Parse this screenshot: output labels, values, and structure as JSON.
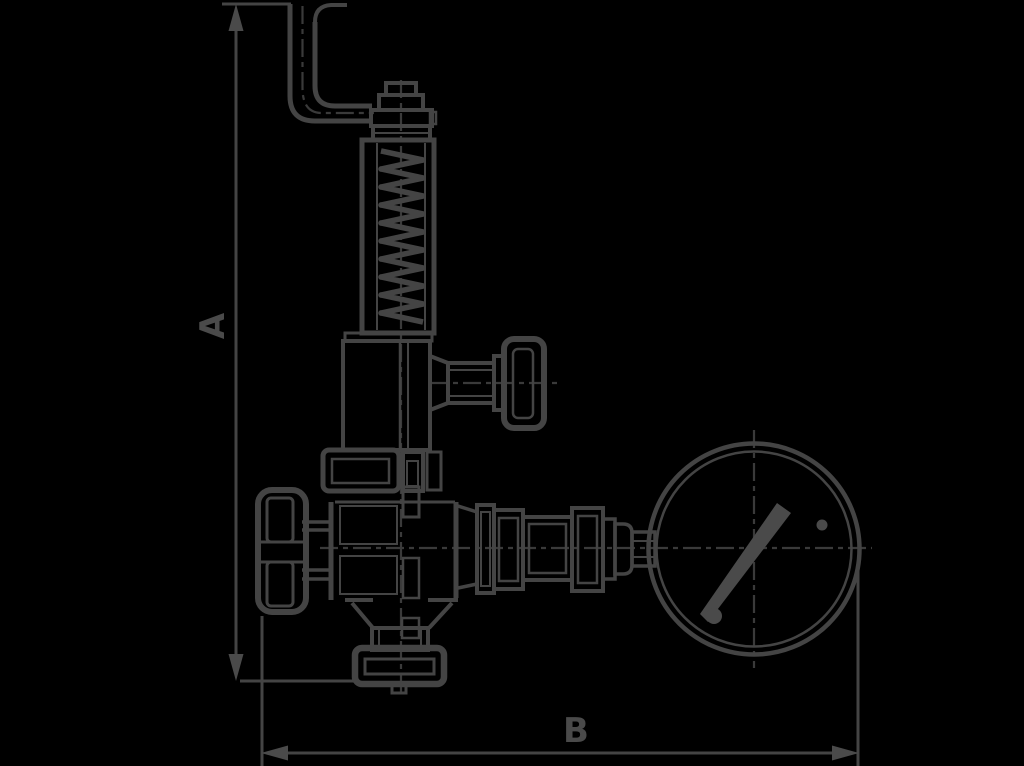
{
  "diagram": {
    "type": "technical-drawing",
    "dimension_labels": {
      "height": "A",
      "width": "B"
    },
    "colors": {
      "background": "#000000",
      "line": "#444444",
      "accent_fill": "#4a4a4a"
    },
    "components": [
      "discharge-elbow-pipe",
      "adjusting-cap",
      "spring-housing",
      "spring-coil",
      "bonnet",
      "side-outlet-knob",
      "body-flange",
      "valve-body",
      "handwheel",
      "inlet-flange",
      "gauge-fittings",
      "pressure-gauge",
      "gauge-needle",
      "dimension-A",
      "dimension-B"
    ]
  }
}
